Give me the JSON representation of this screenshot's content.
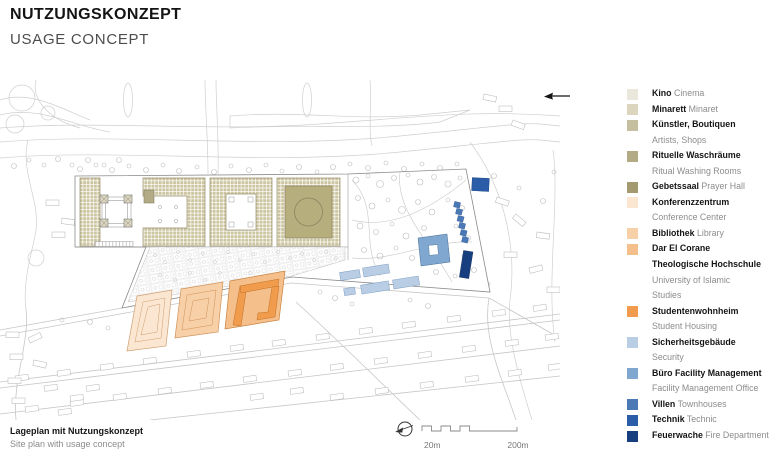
{
  "header": {
    "title_de": "NUTZUNGSKONZEPT",
    "title_en": "USAGE CONCEPT"
  },
  "caption": {
    "de": "Lageplan mit Nutzungskonzept",
    "en": "Site plan with usage concept"
  },
  "scalebar": {
    "label_20m": "20m",
    "label_200m": "200m"
  },
  "nav": {
    "back_arrow_icon": "arrow-left"
  },
  "north_arrow_icon": "north-arrow",
  "colors": {
    "kino": "#eae7dc",
    "minarett": "#ddd6bf",
    "kuenstler": "#c6bf9f",
    "waschraeume": "#b3ab85",
    "gebetssaal": "#a39a6f",
    "konferenzzentrum": "#fbe7d1",
    "bibliothek": "#f8d0a8",
    "dar_el_corane": "#f5bf8b",
    "studentenwohnheim": "#f09c4c",
    "sicherheitsgebaeude": "#b9cee5",
    "buero_fm": "#7fa7cf",
    "villen": "#4a79b6",
    "technik": "#2a5ca8",
    "feuerwache": "#173f80",
    "hatch": "#cbc49f",
    "hatch_dark": "#b7ae7d",
    "text_primary": "#141414",
    "text_secondary": "#8c8c8c"
  },
  "legend": {
    "entries": [
      {
        "id": "kino",
        "color": "#eae7dc",
        "rows": [
          [
            {
              "t": "Kino",
              "b": 1
            },
            {
              "t": "Cinema",
              "b": 0
            }
          ]
        ]
      },
      {
        "id": "minarett",
        "color": "#ddd6bf",
        "rows": [
          [
            {
              "t": "Minarett",
              "b": 1
            },
            {
              "t": "Minaret",
              "b": 0
            }
          ]
        ]
      },
      {
        "id": "kuenstler",
        "color": "#c6bf9f",
        "rows": [
          [
            {
              "t": "Künstler, Boutiquen",
              "b": 1
            }
          ],
          [
            {
              "t": "Artists, Shops",
              "b": 0
            }
          ]
        ]
      },
      {
        "id": "waschraeume",
        "color": "#b3ab85",
        "rows": [
          [
            {
              "t": "Rituelle Waschräume",
              "b": 1
            }
          ],
          [
            {
              "t": "Ritual Washing Rooms",
              "b": 0
            }
          ]
        ]
      },
      {
        "id": "gebetssaal",
        "color": "#a39a6f",
        "rows": [
          [
            {
              "t": "Gebetssaal",
              "b": 1
            },
            {
              "t": "Prayer Hall",
              "b": 0
            }
          ]
        ]
      },
      {
        "id": "konferenzzentrum",
        "color": "#fbe7d1",
        "rows": [
          [
            {
              "t": "Konferenzzentrum",
              "b": 1
            }
          ],
          [
            {
              "t": "Conference Center",
              "b": 0
            }
          ]
        ]
      },
      {
        "id": "bibliothek",
        "color": "#f8d0a8",
        "rows": [
          [
            {
              "t": "Bibliothek",
              "b": 1
            },
            {
              "t": "Library",
              "b": 0
            }
          ]
        ]
      },
      {
        "id": "dar_el_corane",
        "color": "#f5bf8b",
        "rows": [
          [
            {
              "t": "Dar El Corane",
              "b": 1
            }
          ],
          [
            {
              "t": "Theologische Hochschule",
              "b": 1
            }
          ],
          [
            {
              "t": "University of Islamic",
              "b": 0
            }
          ],
          [
            {
              "t": "Studies",
              "b": 0
            }
          ]
        ]
      },
      {
        "id": "studentenwohnheim",
        "color": "#f09c4c",
        "rows": [
          [
            {
              "t": "Studentenwohnheim",
              "b": 1
            }
          ],
          [
            {
              "t": "Student Housing",
              "b": 0
            }
          ]
        ]
      },
      {
        "id": "sicherheitsgebaeude",
        "color": "#b9cee5",
        "rows": [
          [
            {
              "t": "Sicherheitsgebäude",
              "b": 1
            }
          ],
          [
            {
              "t": "Security",
              "b": 0
            }
          ]
        ]
      },
      {
        "id": "buero_fm",
        "color": "#7fa7cf",
        "rows": [
          [
            {
              "t": "Büro Facility Management",
              "b": 1
            }
          ],
          [
            {
              "t": "Facility Management Office",
              "b": 0
            }
          ]
        ]
      },
      {
        "id": "villen",
        "color": "#4a79b6",
        "rows": [
          [
            {
              "t": "Villen",
              "b": 1
            },
            {
              "t": "Townhouses",
              "b": 0
            }
          ]
        ]
      },
      {
        "id": "technik",
        "color": "#2a5ca8",
        "rows": [
          [
            {
              "t": "Technik",
              "b": 1
            },
            {
              "t": "Technic",
              "b": 0
            }
          ]
        ]
      },
      {
        "id": "feuerwache",
        "color": "#173f80",
        "rows": [
          [
            {
              "t": "Feuerwache",
              "b": 1
            },
            {
              "t": "Fire Department",
              "b": 0
            }
          ]
        ]
      }
    ]
  }
}
